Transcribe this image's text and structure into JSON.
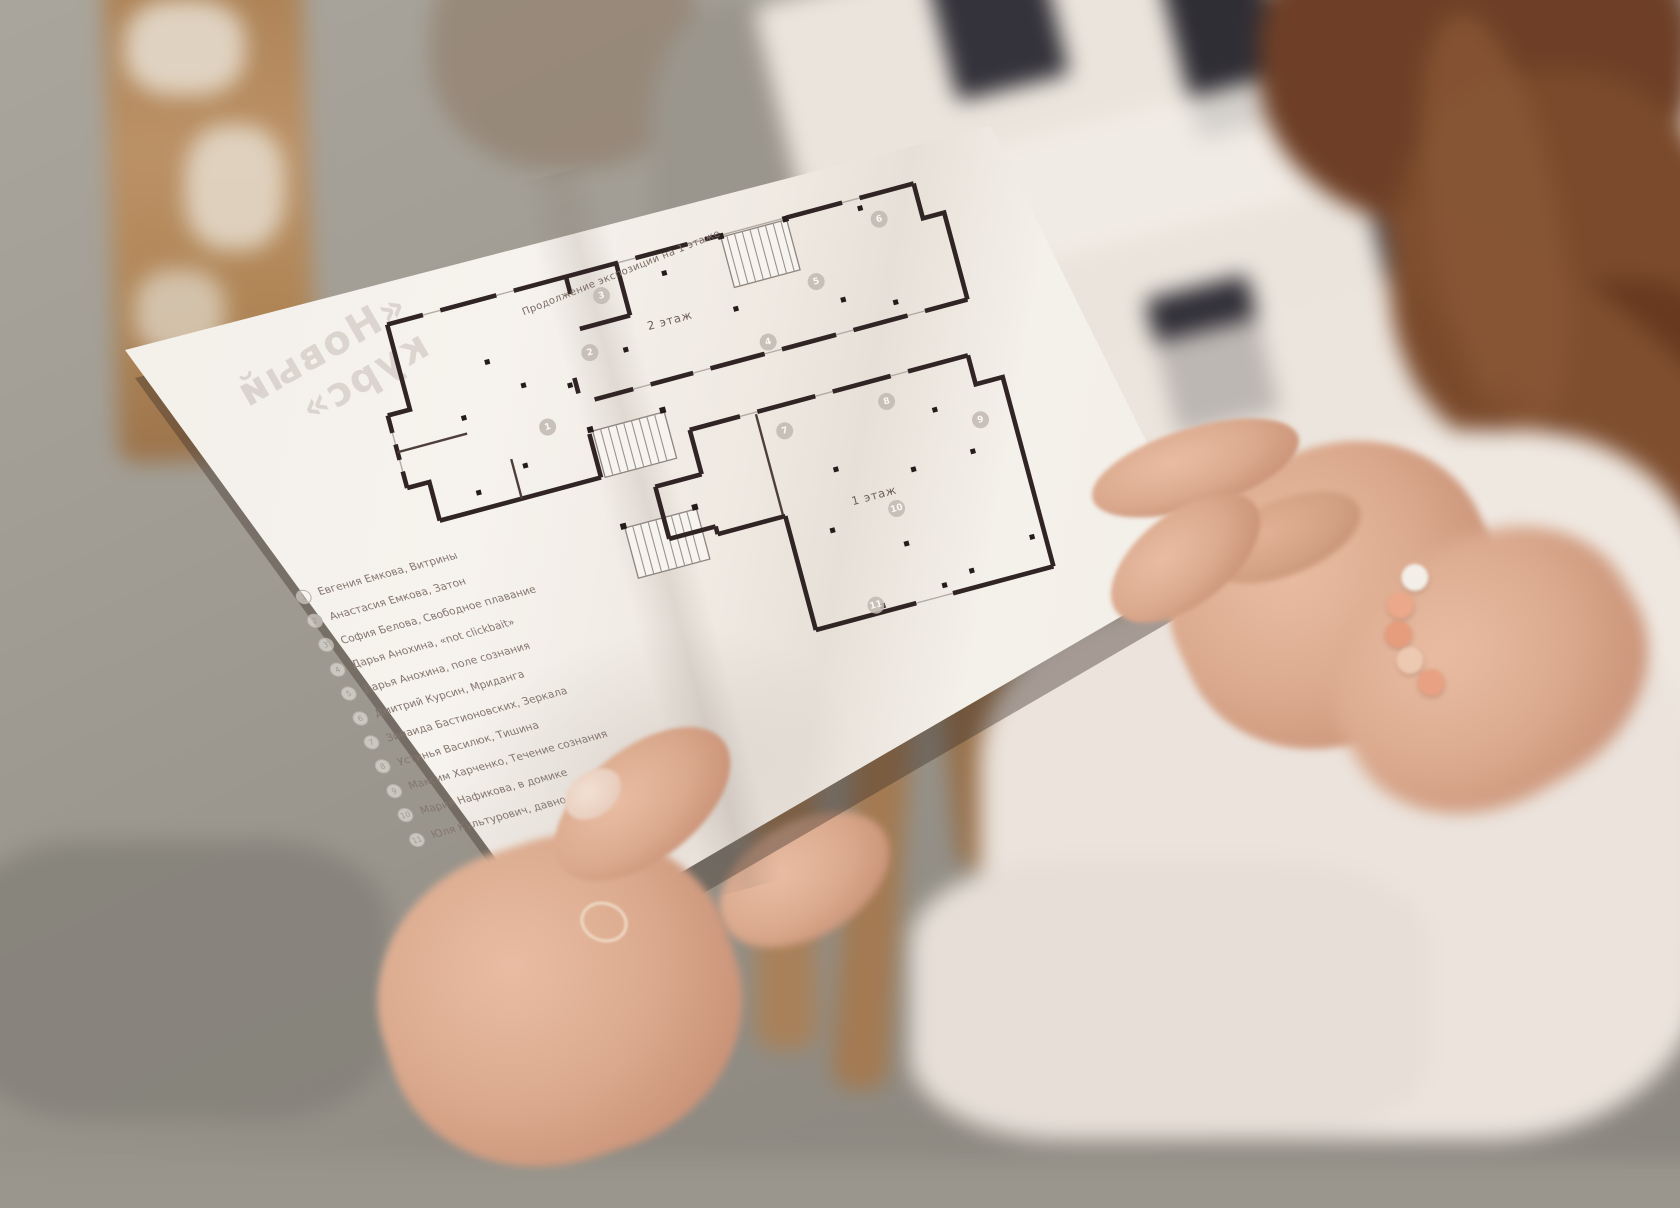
{
  "paper": {
    "title": "Продолжение экспозиции на 1 этаже",
    "cover_bleed": {
      "line1": "«Новый",
      "line2": "курс»"
    },
    "floors": {
      "second": "2 этаж",
      "first": "1 этаж"
    },
    "markers": [
      "1",
      "2",
      "3",
      "4",
      "5",
      "6",
      "7",
      "8",
      "9",
      "10",
      "11"
    ],
    "list": {
      "items": [
        {
          "number": "1",
          "label": "Евгения Емкова, Витрины"
        },
        {
          "number": "2",
          "label": "Анастасия Емкова, Затон"
        },
        {
          "number": "3",
          "label": "София Белова, Свободное плавание"
        },
        {
          "number": "4",
          "label": "Дарья Анохина, «not clickbait»"
        },
        {
          "number": "5",
          "label": "Дарья Анохина, поле сознания"
        },
        {
          "number": "6",
          "label": "Дмитрий Курсин, Мриданга"
        },
        {
          "number": "7",
          "label": "Зинаида Бастионовских, Зеркала"
        },
        {
          "number": "8",
          "label": "Устинья Василюк, Тишина"
        },
        {
          "number": "9",
          "label": "Максим Харченко, Течение сознания"
        },
        {
          "number": "10",
          "label": "Мария Нафикова, в домике"
        },
        {
          "number": "11",
          "label": "Юля Культурович, давно не видел"
        }
      ]
    }
  },
  "colors": {
    "plan_ink": "#312424",
    "marker_gray": "#c3bbb3",
    "paper": "#f5f1ec",
    "skin": "#d9a98e",
    "hair": "#74452b",
    "wood": "#b5895f",
    "wall": "#a3a099",
    "blouse": "#ece4dd",
    "picture_frame_dark": "#34323a"
  }
}
